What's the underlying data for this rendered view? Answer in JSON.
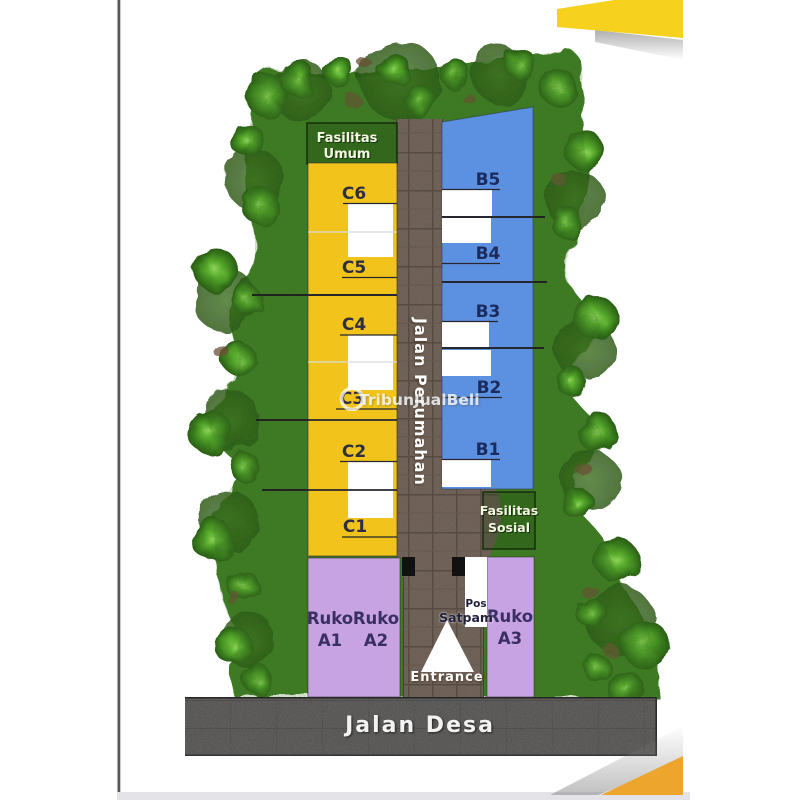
{
  "watermark": {
    "text": "TribunJualBeli"
  },
  "site_plan": {
    "roads": {
      "main_vertical": "Jalan Perumahan",
      "bottom": "Jalan Desa",
      "entrance": "Entrance"
    },
    "facility_top": {
      "line1": "Fasilitas",
      "line2": "Umum"
    },
    "facility_right": {
      "line1": "Fasilitas",
      "line2": "Sosial"
    },
    "guard_post": {
      "line1": "Pos",
      "line2": "Satpam"
    },
    "blocks": {
      "b": [
        "B5",
        "B4",
        "B3",
        "B2",
        "B1"
      ],
      "c": [
        "C6",
        "C5",
        "C4",
        "C3",
        "C2",
        "C1"
      ],
      "ruko": [
        {
          "name": "Ruko",
          "unit": "A1"
        },
        {
          "name": "Ruko",
          "unit": "A2"
        },
        {
          "name": "Ruko",
          "unit": "A3"
        }
      ]
    },
    "colors": {
      "block_b": "#5C90E0",
      "block_c": "#F2C41B",
      "block_ruko": "#C8A3E4",
      "grass": "#3D7A20",
      "road_paver": "#77675C",
      "road_asphalt": "#4E4E4E",
      "accent_top": "#F6D21F",
      "accent_bottom": "#EEA52D"
    }
  }
}
